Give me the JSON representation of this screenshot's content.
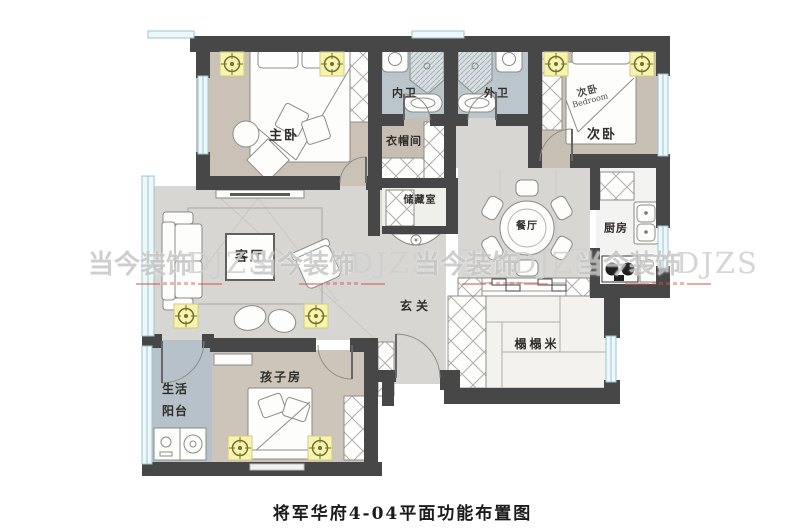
{
  "title": "将军华府4-04平面功能布置图",
  "watermark": {
    "cn": "当今装饰",
    "en": "DJZS"
  },
  "rooms": {
    "master_bedroom": "主卧",
    "closet": "衣帽间",
    "inner_bath": "内卫",
    "outer_bath": "外卫",
    "second_bedroom": "次卧",
    "kitchen": "厨房",
    "dining": "餐厅",
    "storage": "储藏室",
    "living": "客厅",
    "entry": "玄关",
    "tatami": "榻榻米",
    "kids_room": "孩子房",
    "balcony_line1": "生活",
    "balcony_line2": "阳台"
  },
  "bed_stamp": {
    "cn": "次卧",
    "en": "Bedroom"
  },
  "colors": {
    "wall": "#474747",
    "floor_wood": "#cbc2b7",
    "floor_gray": "#d7d6d3",
    "floor_blue": "#bac5cc",
    "window_frame": "#9cc4d0",
    "light_fill": "#f8f4ac",
    "watermark_red": "#cf5848"
  }
}
